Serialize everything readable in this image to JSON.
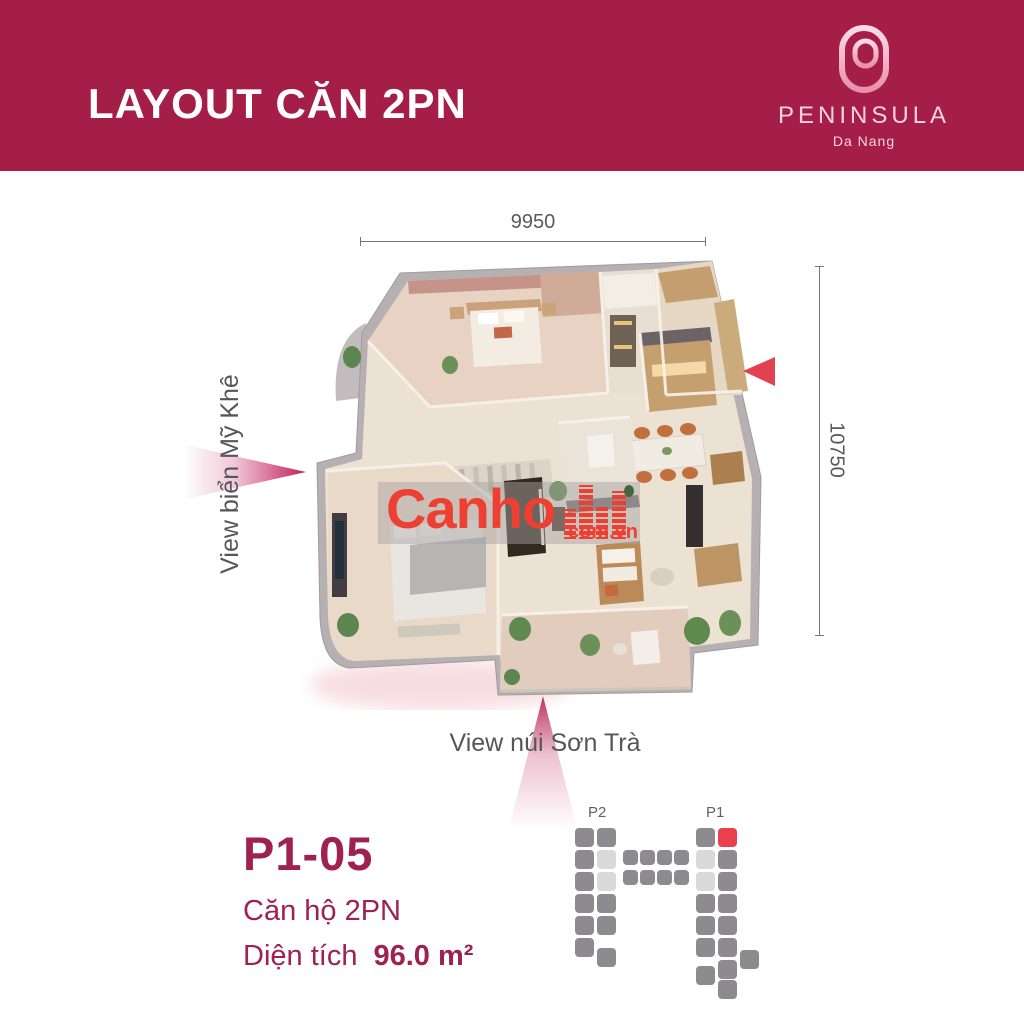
{
  "header": {
    "title": "LAYOUT CĂN 2PN",
    "bg_color": "#a41e48"
  },
  "logo": {
    "monogram": "P",
    "brand": "PENINSULA",
    "city": "Da Nang"
  },
  "plan": {
    "dim_width": "9950",
    "dim_height": "10750",
    "view_left": "View biển Mỹ Khê",
    "view_bottom": "View núi Sơn Trà",
    "entrance_arrow_color": "#e2414f"
  },
  "unit": {
    "code": "P1-05",
    "type": "Căn hộ 2PN",
    "area_label": "Diện tích",
    "area_value": "96.0 m²"
  },
  "watermark": {
    "name": "Canho",
    "suffix": "com.vn",
    "color": "#ee3f33"
  },
  "minimap": {
    "left_tower": "P2",
    "right_tower": "P1",
    "square": 19,
    "colors": {
      "g": "#8d8b90",
      "l": "#d9d8db",
      "r": "#e9404d"
    },
    "squares": [
      [
        7,
        0,
        "g"
      ],
      [
        7,
        22,
        "g"
      ],
      [
        7,
        44,
        "g"
      ],
      [
        7,
        66,
        "g"
      ],
      [
        7,
        88,
        "g"
      ],
      [
        7,
        110,
        "g"
      ],
      [
        29,
        0,
        "g"
      ],
      [
        29,
        22,
        "l"
      ],
      [
        29,
        44,
        "l"
      ],
      [
        29,
        66,
        "g"
      ],
      [
        29,
        88,
        "g"
      ],
      [
        29,
        120,
        "g"
      ],
      [
        55,
        22,
        "g",
        15,
        15
      ],
      [
        72,
        22,
        "g",
        15,
        15
      ],
      [
        89,
        22,
        "g",
        15,
        15
      ],
      [
        106,
        22,
        "g",
        15,
        15
      ],
      [
        55,
        42,
        "g",
        15,
        15
      ],
      [
        72,
        42,
        "g",
        15,
        15
      ],
      [
        89,
        42,
        "g",
        15,
        15
      ],
      [
        106,
        42,
        "g",
        15,
        15
      ],
      [
        128,
        0,
        "g"
      ],
      [
        128,
        22,
        "l"
      ],
      [
        128,
        44,
        "l"
      ],
      [
        128,
        66,
        "g"
      ],
      [
        128,
        88,
        "g"
      ],
      [
        128,
        110,
        "g"
      ],
      [
        128,
        138,
        "g"
      ],
      [
        150,
        0,
        "r"
      ],
      [
        150,
        22,
        "g"
      ],
      [
        150,
        44,
        "g"
      ],
      [
        150,
        66,
        "g"
      ],
      [
        150,
        88,
        "g"
      ],
      [
        150,
        110,
        "g"
      ],
      [
        150,
        132,
        "g"
      ],
      [
        150,
        152,
        "g"
      ],
      [
        172,
        122,
        "g"
      ]
    ]
  },
  "icons": {
    "entrance-arrow": "left-triangle",
    "view-arrow-left": "right-pointing-gradient-triangle",
    "view-arrow-up": "up-pointing-gradient-triangle",
    "brand-monogram": "peninsula-p-ring"
  }
}
